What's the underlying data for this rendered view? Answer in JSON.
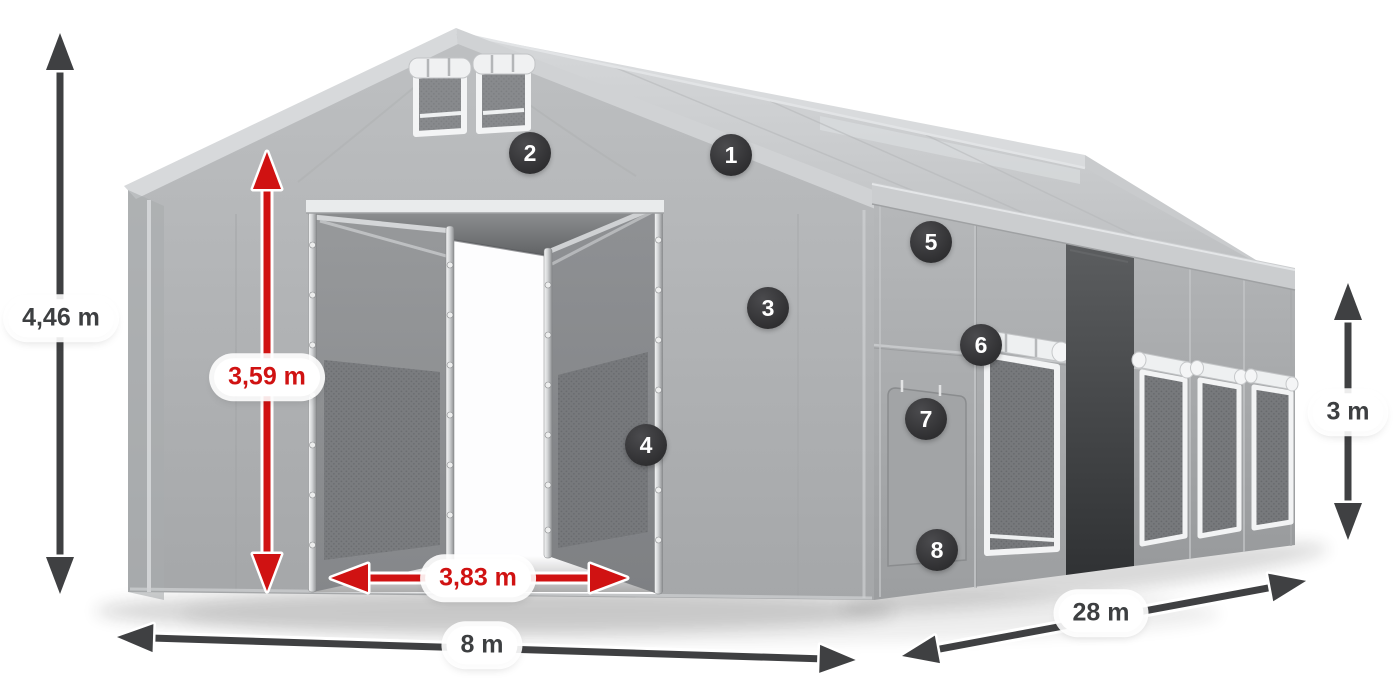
{
  "dimension_labels": {
    "total_height": {
      "text": "4,46 m",
      "color": "#3d3f41"
    },
    "entrance_height": {
      "text": "3,59 m",
      "color": "#d01212"
    },
    "entrance_width": {
      "text": "3,83 m",
      "color": "#d01212"
    },
    "front_width": {
      "text": "8 m",
      "color": "#3d3f41"
    },
    "side_length": {
      "text": "28 m",
      "color": "#3d3f41"
    },
    "side_wall_height": {
      "text": "3 m",
      "color": "#3d3f41"
    }
  },
  "callouts": [
    {
      "number": "1"
    },
    {
      "number": "2"
    },
    {
      "number": "3"
    },
    {
      "number": "4"
    },
    {
      "number": "5"
    },
    {
      "number": "6"
    },
    {
      "number": "7"
    },
    {
      "number": "8"
    }
  ],
  "colors": {
    "accent_red": "#d01212",
    "arrow_dark": "#3f4042",
    "callout_bg": "#353537",
    "tent_light": "#d2d4d6",
    "tent_mid": "#aeb0b2",
    "tent_interior_dark": "#454749",
    "background": "#ffffff"
  }
}
